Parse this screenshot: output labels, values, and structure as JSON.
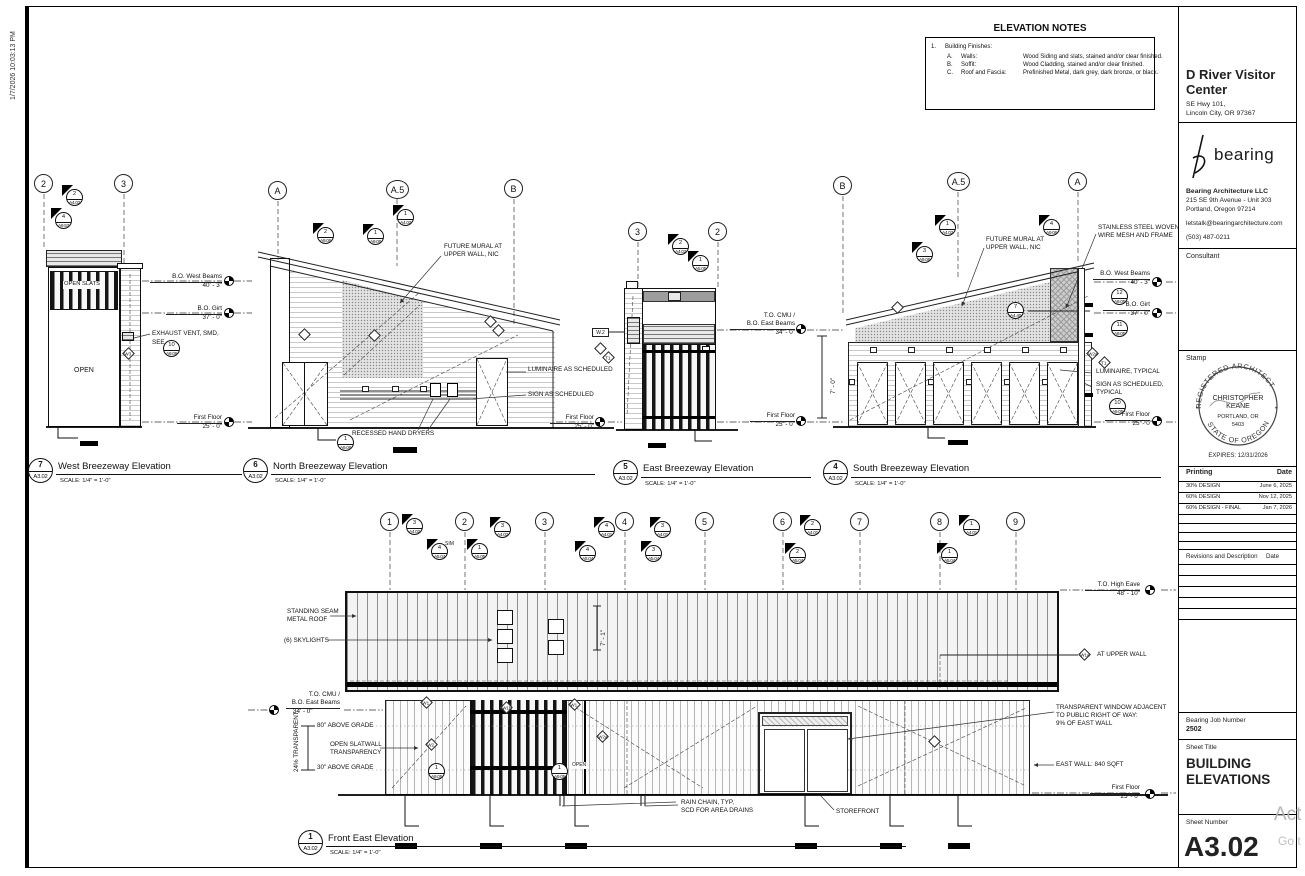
{
  "meta": {
    "plot_timestamp": "1/7/2026 10:03:13 PM",
    "watermark_line1": "Act",
    "watermark_line2": "Go t"
  },
  "common": {
    "scale": "SCALE:  1/4\" = 1'-0\""
  },
  "notes": {
    "title": "ELEVATION NOTES",
    "item_no": "1.",
    "item_title": "Building Finishes:",
    "rows": [
      {
        "letter": "A.",
        "element": "Walls:",
        "finish": "Wood Siding and slats, stained and/or clear finished."
      },
      {
        "letter": "B.",
        "element": "Soffit:",
        "finish": "Wood Cladding, stained and/or clear finished."
      },
      {
        "letter": "C.",
        "element": "Roof and Fascia:",
        "finish": "Prefinished Metal, dark grey, dark bronze, or black."
      }
    ]
  },
  "titleblock": {
    "project_name": "D River Visitor Center",
    "project_address1": "SE Hwy 101,",
    "project_address2": "Lincoln City, OR 97367",
    "logo_text": "bearing",
    "firm_name": "Bearing Architecture LLC",
    "firm_address1": "215 SE 9th Avenue - Unit 303",
    "firm_address2": "Portland, Oregon 97214",
    "firm_email": "letstalk@bearingarchitecture.com",
    "firm_phone": "(503) 487-0211",
    "consultant_label": "Consultant",
    "stamp_label": "Stamp",
    "stamp_arc_top": "REGISTERED ARCHITECT",
    "stamp_arc_bottom": "STATE OF OREGON",
    "stamp_name": "CHRISTOPHER",
    "stamp_name2": "KEANE",
    "stamp_city": "PORTLAND, OR",
    "stamp_no": "5403",
    "stamp_expires": "EXPIRES: 12/31/2026",
    "printing_label": "Printing",
    "date_label": "Date",
    "printing_rows": [
      {
        "label": "30% DESIGN",
        "date": "June 6, 2025"
      },
      {
        "label": "60% DESIGN",
        "date": "Nov 12, 2025"
      },
      {
        "label": "60% DESIGN - FINAL",
        "date": "Jan 7, 2026"
      }
    ],
    "revisions_label": "Revisions and Description",
    "revisions_date_label": "Date",
    "job_label": "Bearing Job Number",
    "job_number": "2502",
    "sheet_title_label": "Sheet Title",
    "sheet_title1": "BUILDING",
    "sheet_title2": "ELEVATIONS",
    "sheet_number_label": "Sheet Number",
    "sheet_number": "A3.02"
  },
  "west": {
    "num": "7",
    "sheet": "A3.02",
    "title": "West Breezeway Elevation",
    "grid1": "2",
    "grid2": "3",
    "flag1_num": "2",
    "flag1_sheet": "A4.02",
    "flag2_num": "4",
    "flag2_sheet": "A9.53",
    "open_slats": "OPEN SLATS",
    "open": "OPEN",
    "lvl1_name": "B.O. West Beams",
    "lvl1_elev": "40' - 3\"",
    "lvl2_name": "B.O. Girt",
    "lvl2_elev": "37' - 0\"",
    "lvl3_name": "First Floor",
    "lvl3_elev": "25' - 0\"",
    "exhaust1": "EXHAUST VENT, SMD,",
    "exhaust2": "SEE",
    "exhaust_num": "10",
    "exhaust_sheet": "A9.06",
    "tag_w3": "W3"
  },
  "north": {
    "num": "6",
    "sheet": "A3.02",
    "title": "North Breezeway Elevation",
    "grid1": "A",
    "grid2": "A.5",
    "grid3": "B",
    "flag1_num": "2",
    "flag1_sheet": "A9.06",
    "flag2_num": "1",
    "flag2_sheet": "A9.06",
    "flag3_num": "1",
    "flag3_sheet": "A4.02",
    "mural1": "FUTURE MURAL AT",
    "mural2": "UPPER WALL, NIC",
    "luminaire": "LUMINAIRE AS SCHEDULED",
    "sign": "SIGN AS SCHEDULED",
    "dryers": "RECESSED HAND DRYERS",
    "circ_num": "1",
    "circ_sheet": "A9.06",
    "ff_name": "First Floor",
    "ff_elev": "25' - 0\""
  },
  "east": {
    "num": "5",
    "sheet": "A3.02",
    "title": "East Breezeway Elevation",
    "grid1": "3",
    "grid2": "2",
    "flag1_num": "2",
    "flag1_sheet": "A4.02",
    "flag2_num": "1",
    "flag2_sheet": "A5.05",
    "lvl1a": "T.O. CMU /",
    "lvl1b": "B.O. East Beams",
    "lvl1_elev": "34' - 0\"",
    "lvl2_name": "First Floor",
    "lvl2_elev": "25' - 0\"",
    "dim": "7' - 0\"",
    "tag_w2": "W.2",
    "tag_t1": "T1"
  },
  "south": {
    "num": "4",
    "sheet": "A3.02",
    "title": "South Breezeway Elevation",
    "grid1": "B",
    "grid2": "A.5",
    "grid3": "A",
    "flag1_num": "1",
    "flag1_sheet": "A4.02",
    "flag2_num": "3",
    "flag2_sheet": "A9.06",
    "flag3_num": "4",
    "flag3_sheet": "A9.06",
    "mural1": "FUTURE MURAL AT",
    "mural2": "UPPER WALL, NIC",
    "mesh1": "STAINLESS STEEL WOVEN",
    "mesh2": "WIRE MESH AND FRAME",
    "lvl1_name": "B.O. West Beams",
    "lvl1_elev": "40' - 3\"",
    "lvl2_name": "B.O. Girt",
    "lvl2_elev": "37' - 0\"",
    "lvl3_name": "First Floor",
    "lvl3_elev": "25' - 0\"",
    "circ1_num": "12",
    "circ1_sheet": "A9.05",
    "circ2_num": "11",
    "circ2_sheet": "A9.05",
    "circ3_num": "10",
    "circ3_sheet": "A9.05",
    "circ4_num": "7",
    "circ4_sheet": "A4.40",
    "luminaire": "LUMINAIRE, TYPICAL",
    "sign1": "SIGN AS SCHEDULED,",
    "sign2": "TYPICAL",
    "tag_w2a": "W2a",
    "tag_t1": "T1"
  },
  "front": {
    "num": "1",
    "sheet": "A3.02",
    "title": "Front East Elevation",
    "grid": [
      "1",
      "2",
      "3",
      "4",
      "5",
      "6",
      "7",
      "8",
      "9"
    ],
    "sim": "SIM",
    "flags": [
      {
        "num": "3",
        "sheet": "A4.02"
      },
      {
        "num": "4",
        "sheet": "A5.04"
      },
      {
        "num": "1",
        "sheet": "A5.05"
      },
      {
        "num": "3",
        "sheet": "A4.02"
      },
      {
        "num": "4",
        "sheet": "A4.01"
      },
      {
        "num": "4",
        "sheet": "A5.04"
      },
      {
        "num": "3",
        "sheet": "A4.01"
      },
      {
        "num": "3",
        "sheet": "A5.04"
      },
      {
        "num": "2",
        "sheet": "A4.01"
      },
      {
        "num": "2",
        "sheet": "A5.04"
      },
      {
        "num": "1",
        "sheet": "A4.01"
      },
      {
        "num": "1",
        "sheet": "A5.04"
      }
    ],
    "roof1": "STANDING SEAM",
    "roof2": "METAL ROOF",
    "skylights": "(6) SKYLIGHTS",
    "cmu1": "T.O. CMU /",
    "cmu2": "B.O. East Beams",
    "cmu_elev": "34' - 0\"",
    "grade80": "80\" ABOVE GRADE",
    "grade30": "30\" ABOVE GRADE",
    "slat1": "OPEN SLATWALL",
    "slat2": "TRANSPARENCY",
    "pct": "24% TRANSPARENT",
    "eave_name": "T.O. High Eave",
    "eave_elev": "48' - 10\"",
    "upper_wall": "AT UPPER WALL",
    "win1": "TRANSPARENT WINDOW ADJACENT",
    "win2": "TO PUBLIC RIGHT OF WAY:",
    "win3": "9% OF EAST WALL",
    "east_wall": "EAST WALL: 840 SQFT",
    "ff_name": "First Floor",
    "ff_elev": "25' - 0\"",
    "rain1": "RAIN CHAIN, TYP,",
    "rain2": "SCD FOR AREA DRAINS",
    "storefront": "STOREFRONT",
    "open": "OPEN",
    "dim": "7' - 1\"",
    "circ_num": "1",
    "circ_sheet": "A9.05",
    "tag_w1": "W1",
    "tag_w1b": "W1b",
    "tag_w2": "W2",
    "tag_w2a": "W2a",
    "tag_w1a": "W1a"
  }
}
